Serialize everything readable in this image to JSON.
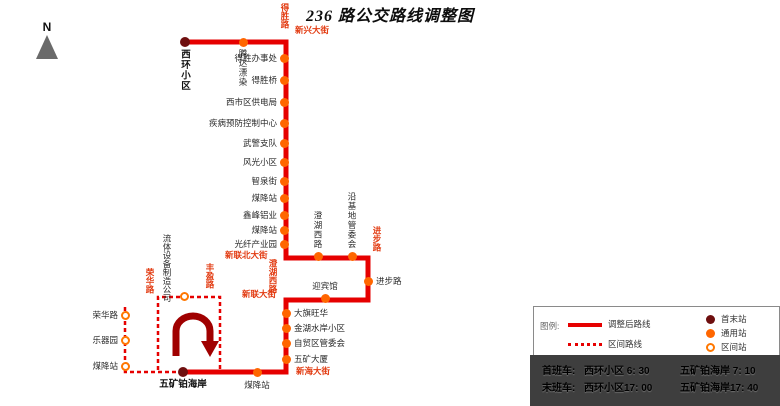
{
  "title": "236 路公交路线调整图",
  "compass": {
    "label": "N"
  },
  "colors": {
    "route_red": "#e60000",
    "street_label_red": "#e23a10",
    "stop_orange": "#ff6600",
    "terminal_dark_red": "#6e0f0f",
    "uturn_arrow": "#a00000",
    "timetable_bg": "#3e3e3e"
  },
  "map": {
    "routes": [
      {
        "kind": "main",
        "points": "185,42 286,42 286,258 368,258 368,300 286,300 286,372 183,372"
      },
      {
        "kind": "section",
        "points": "183,372 125,372 125,307"
      },
      {
        "kind": "section",
        "points": "158,370 158,297 220,297 220,370"
      }
    ],
    "uturn": {
      "path": "M 176 356 L 176 331 A 17 15 0 1 1 210 331 L 210 343",
      "head": "201,341 219,341 210,357"
    },
    "streets": [
      {
        "name": "得胜路",
        "dir": "v",
        "x": 280,
        "y": 3
      },
      {
        "name": "新兴大街",
        "dir": "h",
        "x": 295,
        "y": 25
      },
      {
        "name": "新联北大街",
        "dir": "h",
        "x": 225,
        "y": 250
      },
      {
        "name": "澄湖西路",
        "dir": "v",
        "x": 268,
        "y": 259
      },
      {
        "name": "进步路",
        "dir": "v",
        "x": 372,
        "y": 226
      },
      {
        "name": "新联大街",
        "dir": "h",
        "x": 242,
        "y": 289
      },
      {
        "name": "新海大街",
        "dir": "h",
        "x": 296,
        "y": 366
      },
      {
        "name": "荣华路",
        "dir": "v",
        "x": 145,
        "y": 268
      },
      {
        "name": "丰盈路",
        "dir": "v",
        "x": 205,
        "y": 263
      }
    ],
    "stations": [
      {
        "name": "西环小区",
        "kind": "terminal",
        "x": 185,
        "y": 42,
        "label": "v-below",
        "bold": true
      },
      {
        "name": "腾达漂染",
        "kind": "stop",
        "x": 243,
        "y": 42,
        "label": "v-below"
      },
      {
        "name": "得胜办事处",
        "kind": "stop",
        "x": 284,
        "y": 58,
        "label": "left"
      },
      {
        "name": "得胜桥",
        "kind": "stop",
        "x": 284,
        "y": 80,
        "label": "left"
      },
      {
        "name": "西市区供电局",
        "kind": "stop",
        "x": 284,
        "y": 102,
        "label": "left"
      },
      {
        "name": "疾病预防控制中心",
        "kind": "stop",
        "x": 284,
        "y": 123,
        "label": "left"
      },
      {
        "name": "武警支队",
        "kind": "stop",
        "x": 284,
        "y": 143,
        "label": "left"
      },
      {
        "name": "风光小区",
        "kind": "stop",
        "x": 284,
        "y": 162,
        "label": "left"
      },
      {
        "name": "智泉街",
        "kind": "stop",
        "x": 284,
        "y": 181,
        "label": "left"
      },
      {
        "name": "煤降站",
        "kind": "stop",
        "x": 284,
        "y": 198,
        "label": "left"
      },
      {
        "name": "鑫峰铝业",
        "kind": "stop",
        "x": 284,
        "y": 215,
        "label": "left"
      },
      {
        "name": "煤降站",
        "kind": "stop",
        "x": 284,
        "y": 230,
        "label": "left"
      },
      {
        "name": "光纤产业园",
        "kind": "stop",
        "x": 284,
        "y": 244,
        "label": "left"
      },
      {
        "name": "澄湖西路",
        "kind": "stop",
        "x": 318,
        "y": 256,
        "label": "v-above"
      },
      {
        "name": "沿基地管委会",
        "kind": "stop",
        "x": 352,
        "y": 256,
        "label": "v-above"
      },
      {
        "name": "进步路",
        "kind": "stop",
        "x": 368,
        "y": 281,
        "label": "right"
      },
      {
        "name": "迎宾馆",
        "kind": "stop",
        "x": 325,
        "y": 298,
        "label": "above"
      },
      {
        "name": "大旗旺华",
        "kind": "stop",
        "x": 286,
        "y": 313,
        "label": "right"
      },
      {
        "name": "金湖水岸小区",
        "kind": "stop",
        "x": 286,
        "y": 328,
        "label": "right"
      },
      {
        "name": "自贸区管委会",
        "kind": "stop",
        "x": 286,
        "y": 343,
        "label": "right"
      },
      {
        "name": "五矿大厦",
        "kind": "stop",
        "x": 286,
        "y": 359,
        "label": "right"
      },
      {
        "name": "煤降站",
        "kind": "stop",
        "x": 257,
        "y": 372,
        "label": "below"
      },
      {
        "name": "五矿铂海岸",
        "kind": "terminal",
        "x": 183,
        "y": 372,
        "label": "below",
        "bold": true
      },
      {
        "name": "流体设备制造公司",
        "kind": "section",
        "x": 184,
        "y": 296,
        "label": "v2-above"
      },
      {
        "name": "荣华路",
        "kind": "section",
        "x": 125,
        "y": 315,
        "label": "left"
      },
      {
        "name": "乐器园",
        "kind": "section",
        "x": 125,
        "y": 340,
        "label": "left"
      },
      {
        "name": "煤降站",
        "kind": "section",
        "x": 125,
        "y": 366,
        "label": "left"
      }
    ]
  },
  "legend": {
    "title": "图例:",
    "items": [
      {
        "swatch": "solid-line",
        "label": "调整后路线"
      },
      {
        "swatch": "dashed-line",
        "label": "区间路线"
      },
      {
        "swatch": "terminal-dot",
        "label": "首末站"
      },
      {
        "swatch": "stop-dot",
        "label": "通用站"
      },
      {
        "swatch": "section-dot",
        "label": "区间站"
      }
    ]
  },
  "timetable": {
    "rows": [
      {
        "label": "首班车:",
        "left": "西环小区 6: 30",
        "right": "五矿铂海岸 7: 10"
      },
      {
        "label": "末班车:",
        "left": "西环小区17: 00",
        "right": "五矿铂海岸17: 40"
      }
    ]
  }
}
